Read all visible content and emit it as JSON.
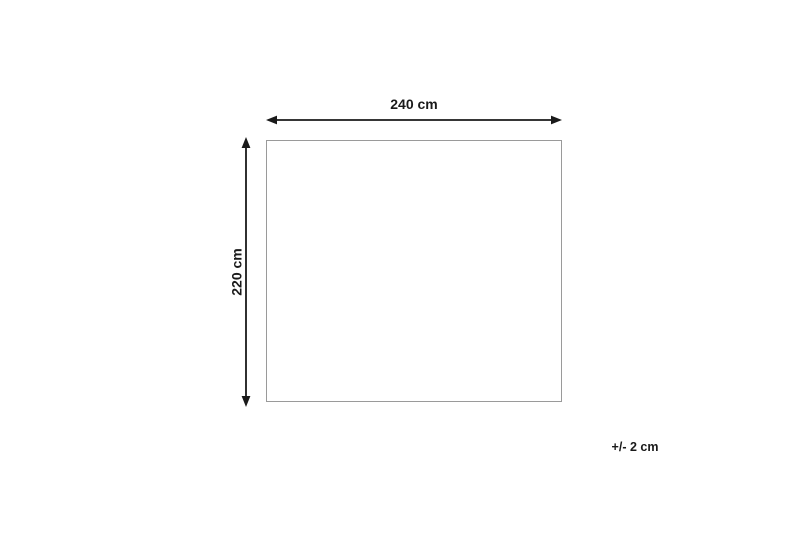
{
  "diagram": {
    "type": "product-dimensions",
    "width_label": "240 cm",
    "height_label": "220 cm",
    "tolerance_label": "+/- 2 cm",
    "colors": {
      "dimension": "#1a1a1a",
      "outline": "#9a9a9a",
      "background": "#ffffff"
    }
  }
}
